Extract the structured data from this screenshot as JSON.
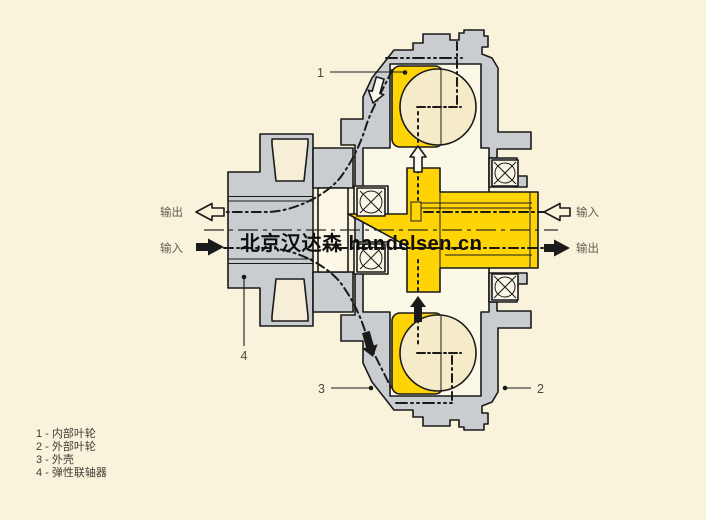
{
  "watermark": {
    "text": "北京汉达森 handelsen.cn"
  },
  "ports": {
    "left_top": {
      "label": "输出",
      "arrow": "hollow-left"
    },
    "left_bottom": {
      "label": "输入",
      "arrow": "solid-right"
    },
    "right_top": {
      "label": "输入",
      "arrow": "hollow-left"
    },
    "right_bottom": {
      "label": "输出",
      "arrow": "solid-right"
    }
  },
  "callouts": {
    "n1": "1",
    "n2": "2",
    "n3": "3",
    "n4": "4"
  },
  "legend": {
    "items": [
      {
        "number": "1",
        "label": "内部叶轮",
        "display": "1 - 内部叶轮"
      },
      {
        "number": "2",
        "label": "外部叶轮",
        "display": "2 - 外部叶轮"
      },
      {
        "number": "3",
        "label": "外壳",
        "display": "3 - 外壳"
      },
      {
        "number": "4",
        "label": "弹性联轴器",
        "display": "4 - 弹性联轴器"
      }
    ]
  },
  "colors": {
    "background": "#faf3dc",
    "housing_gray": "#c9cdd0",
    "impeller_yellow": "#ffd405",
    "chamber_cream": "#f5ebc8",
    "cavity_backing": "#fcf8e8",
    "white_parts": "#fbf6e6",
    "outline_black": "#1a1a1a"
  }
}
